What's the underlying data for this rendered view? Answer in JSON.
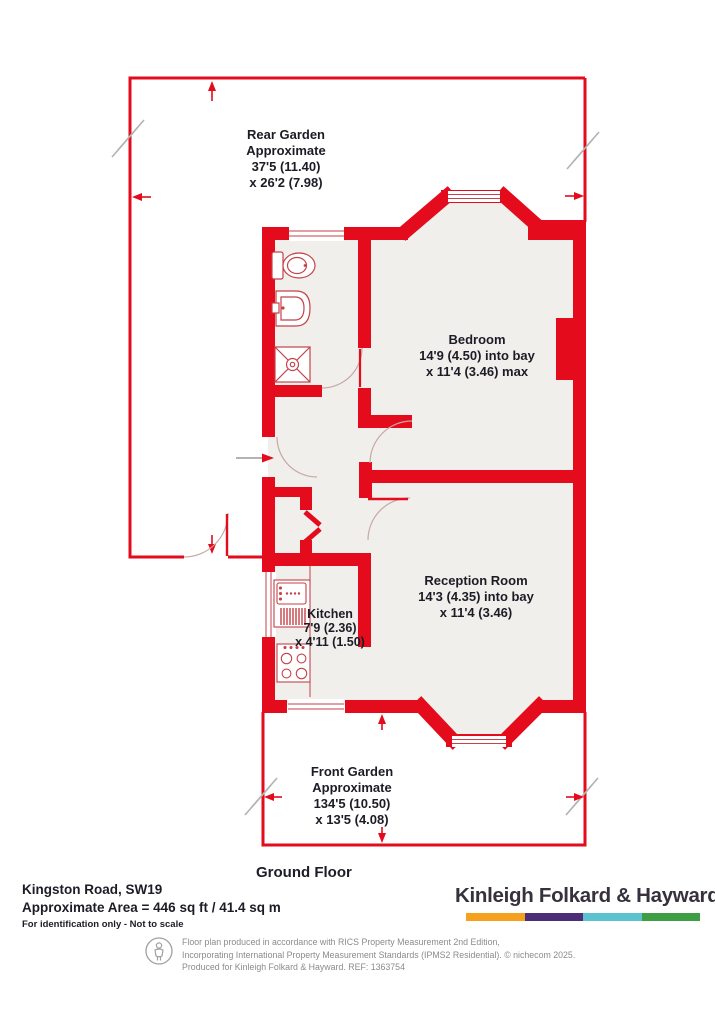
{
  "plan": {
    "rear_garden": {
      "l1": "Rear Garden",
      "l2": "Approximate",
      "l3": "37'5 (11.40)",
      "l4": "x 26'2 (7.98)"
    },
    "bedroom": {
      "l1": "Bedroom",
      "l2": "14'9 (4.50) into bay",
      "l3": "x 11'4 (3.46) max"
    },
    "kitchen": {
      "l1": "Kitchen",
      "l2": "7'9 (2.36)",
      "l3": "x 4'11 (1.50)"
    },
    "reception": {
      "l1": "Reception Room",
      "l2": "14'3 (4.35) into bay",
      "l3": "x 11'4 (3.46)"
    },
    "front_garden": {
      "l1": "Front Garden",
      "l2": "Approximate",
      "l3": "134'5 (10.50)",
      "l4": "x 13'5 (4.08)"
    },
    "floor_label": "Ground Floor"
  },
  "footer": {
    "address": "Kingston Road, SW19",
    "area": "Approximate Area = 446 sq ft / 41.4 sq m",
    "note": "For identification only - Not to scale",
    "brand": "Kinleigh Folkard & Hayward",
    "brand_colors": {
      "orange": "#f5a11d",
      "purple": "#4b2e77",
      "teal": "#5bc2cf",
      "green": "#3e9e44"
    },
    "disclaimer_l1": "Floor plan produced in accordance with RICS Property Measurement 2nd Edition,",
    "disclaimer_l2": "Incorporating International Property Measurement Standards (IPMS2 Residential).   © nichecom 2025.",
    "disclaimer_l3": "Produced for Kinleigh Folkard & Hayward.   REF: 1363754"
  },
  "colors": {
    "wall_red": "#e30b1c",
    "floor_fill": "#f1efec",
    "label_ink": "#1c1c26"
  }
}
